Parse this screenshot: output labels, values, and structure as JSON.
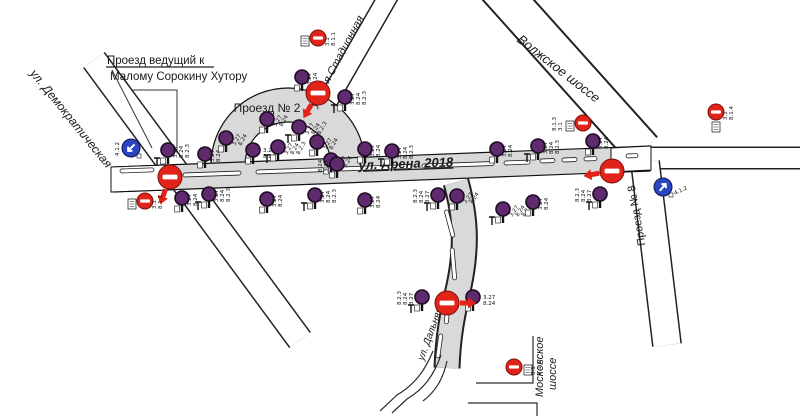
{
  "diagram": {
    "kind": "traffic-sign-placement-scheme"
  },
  "labels": {
    "note_line1": "Проезд ведущий к",
    "note_line2": "Малому Сорокину Хутору",
    "demokraticheskaya": "ул. Демократическая",
    "proezd2": "Проезд № 2",
    "stadionnaya": "ул. 2-я Стадионная",
    "arena": "ул. Арена 2018",
    "volzhskoe": "Волжское шоссе",
    "proezd8": "Проезд № 8",
    "dalnyaya": "ул. Дальняя",
    "moskovskoe_line1": "Московское",
    "moskovskoe_line2": "шоссе"
  },
  "colors": {
    "no_stop": "#5f2a6e",
    "no_entry": "#e2231a",
    "mandatory": "#2b45c0",
    "road_fill": "#d9d9d9"
  },
  "signs": [
    {
      "x": 168,
      "y": 150,
      "codes": [
        "3.27",
        "8.24",
        "8.2.3"
      ]
    },
    {
      "x": 205,
      "y": 154,
      "codes": [
        "3.27",
        "8.24"
      ]
    },
    {
      "x": 226,
      "y": 138,
      "codes": [
        "3.27",
        "8.24"
      ],
      "rot": -60
    },
    {
      "x": 253,
      "y": 150,
      "codes": [
        "3.27",
        "8.24"
      ],
      "rot": 0
    },
    {
      "x": 278,
      "y": 147,
      "codes": [
        "3.27",
        "8.24",
        "8.2.3"
      ],
      "rot": -60
    },
    {
      "x": 267,
      "y": 119,
      "codes": [
        "3.27",
        "8.24"
      ],
      "rot": -60
    },
    {
      "x": 299,
      "y": 127,
      "codes": [
        "3.27",
        "8.24",
        "8.2.3"
      ],
      "rot": -60
    },
    {
      "x": 317,
      "y": 142,
      "codes": [
        "3.27",
        "8.24"
      ],
      "rot": -60
    },
    {
      "x": 331,
      "y": 160,
      "codes": [
        "3.27",
        "8.24"
      ],
      "rot": -60
    },
    {
      "x": 302,
      "y": 77,
      "codes": [
        "3.27",
        "8.24"
      ]
    },
    {
      "x": 345,
      "y": 97,
      "codes": [
        "3.27",
        "8.24",
        "8.2.3"
      ]
    },
    {
      "x": 337,
      "y": 164,
      "codes": [
        "3.27",
        "8.24"
      ],
      "side": "l"
    },
    {
      "x": 365,
      "y": 149,
      "codes": [
        "3.27",
        "8.24"
      ]
    },
    {
      "x": 392,
      "y": 151,
      "codes": [
        "3.27",
        "8.24",
        "8.2.3"
      ]
    },
    {
      "x": 497,
      "y": 149,
      "codes": [
        "3.27",
        "8.24"
      ]
    },
    {
      "x": 538,
      "y": 146,
      "codes": [
        "3.27",
        "8.24",
        "8.2.3"
      ]
    },
    {
      "x": 593,
      "y": 141,
      "codes": [
        "3.27",
        "8.24"
      ]
    },
    {
      "x": 182,
      "y": 198,
      "codes": [
        "3.27",
        "8.24"
      ]
    },
    {
      "x": 209,
      "y": 194,
      "codes": [
        "3.27",
        "8.24",
        "8.2.3"
      ]
    },
    {
      "x": 267,
      "y": 199,
      "codes": [
        "3.27",
        "8.24"
      ]
    },
    {
      "x": 315,
      "y": 195,
      "codes": [
        "3.27",
        "8.24",
        "8.2.3"
      ]
    },
    {
      "x": 365,
      "y": 200,
      "codes": [
        "3.27",
        "8.24"
      ]
    },
    {
      "x": 438,
      "y": 195,
      "codes": [
        "3.27",
        "8.24",
        "8.2.3"
      ],
      "side": "l"
    },
    {
      "x": 457,
      "y": 196,
      "codes": [
        "3.27",
        "8.24"
      ],
      "rot": -55
    },
    {
      "x": 503,
      "y": 209,
      "codes": [
        "3.27",
        "8.24",
        "8.2.3"
      ],
      "rot": -55
    },
    {
      "x": 533,
      "y": 202,
      "codes": [
        "3.27",
        "8.24"
      ]
    },
    {
      "x": 600,
      "y": 194,
      "codes": [
        "3.27",
        "8.24",
        "8.2.3"
      ],
      "side": "l"
    },
    {
      "x": 422,
      "y": 297,
      "codes": [
        "3.27",
        "8.24",
        "8.2.3"
      ],
      "side": "l"
    },
    {
      "x": 473,
      "y": 297,
      "codes": [
        "3.27",
        "8.24"
      ],
      "rot": 0
    },
    {
      "x": 170,
      "y": 177,
      "t": "neb",
      "arrow": 20
    },
    {
      "x": 318,
      "y": 93,
      "t": "neb",
      "arrow": 30
    },
    {
      "x": 612,
      "y": 171,
      "t": "neb",
      "arrow": 80
    },
    {
      "x": 447,
      "y": 303,
      "t": "neb",
      "arrow": -90
    },
    {
      "x": 145,
      "y": 201,
      "t": "ne",
      "codes": [
        "3.1",
        "8.1.1"
      ],
      "plate": "l"
    },
    {
      "x": 318,
      "y": 38,
      "t": "ne",
      "codes": [
        "3.1",
        "8.1.1"
      ],
      "plate": "l"
    },
    {
      "x": 583,
      "y": 123,
      "t": "ne",
      "codes": [
        "3.1",
        "8.1.3"
      ],
      "plate": "l",
      "side": "l"
    },
    {
      "x": 716,
      "y": 112,
      "t": "ne",
      "codes": [
        "3.1",
        "8.1.4"
      ],
      "plate": "b"
    },
    {
      "x": 514,
      "y": 367,
      "t": "ne",
      "codes": [
        "3.1",
        "8.1.1"
      ],
      "plate": "r"
    },
    {
      "x": 131,
      "y": 148,
      "t": "m",
      "codes": [
        "4.1.2"
      ],
      "side": "l",
      "arrow": -135
    },
    {
      "x": 663,
      "y": 187,
      "t": "m",
      "codes": [
        "4.1.2"
      ],
      "rot": -25,
      "arrow": 40
    }
  ],
  "road_markings": [
    {
      "x": 120,
      "y": 171,
      "len": 34,
      "rot": -2
    },
    {
      "x": 183,
      "y": 175,
      "len": 58,
      "rot": -2
    },
    {
      "x": 256,
      "y": 172,
      "len": 68,
      "rot": -2
    },
    {
      "x": 340,
      "y": 169,
      "len": 72,
      "rot": -2
    },
    {
      "x": 422,
      "y": 166,
      "len": 72,
      "rot": -2
    },
    {
      "x": 504,
      "y": 163,
      "len": 26,
      "rot": -2
    },
    {
      "x": 540,
      "y": 161,
      "len": 15,
      "rot": -2
    },
    {
      "x": 562,
      "y": 160,
      "len": 15,
      "rot": -2
    },
    {
      "x": 584,
      "y": 159,
      "len": 13,
      "rot": -2
    },
    {
      "x": 626,
      "y": 156,
      "len": 12,
      "rot": -2
    },
    {
      "x": 446,
      "y": 210,
      "len": 28,
      "rot": 75
    },
    {
      "x": 452,
      "y": 248,
      "len": 32,
      "rot": 85
    },
    {
      "x": 449,
      "y": 292,
      "len": 32,
      "rot": 95
    },
    {
      "x": 441,
      "y": 334,
      "len": 24,
      "rot": 98
    }
  ]
}
